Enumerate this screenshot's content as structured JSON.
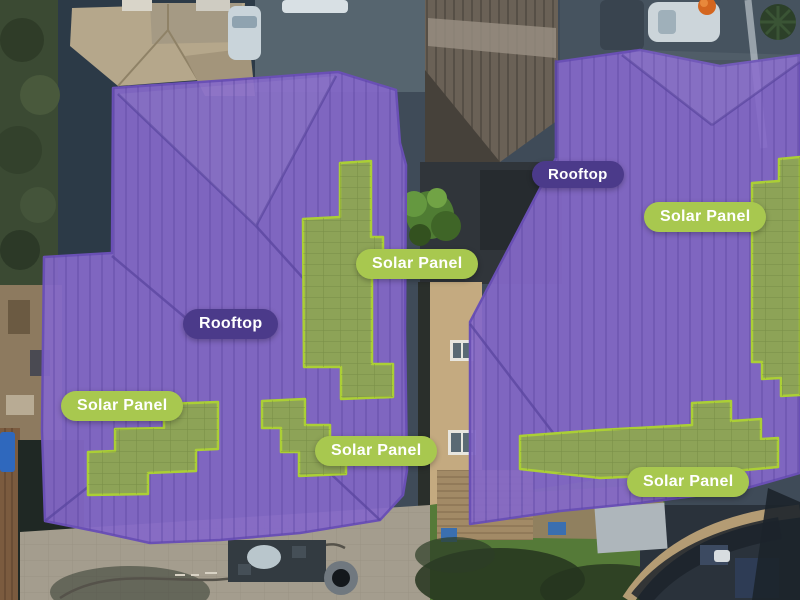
{
  "annotations": [
    {
      "id": "rooftop-left",
      "label": "Rooftop",
      "class": "rooftop"
    },
    {
      "id": "solar-panel-center",
      "label": "Solar Panel",
      "class": "solar_panel"
    },
    {
      "id": "solar-panel-bottom-left",
      "label": "Solar Panel",
      "class": "solar_panel"
    },
    {
      "id": "solar-panel-bottom-mid",
      "label": "Solar Panel",
      "class": "solar_panel"
    },
    {
      "id": "rooftop-right",
      "label": "Rooftop",
      "class": "rooftop"
    },
    {
      "id": "solar-panel-right-top",
      "label": "Solar Panel",
      "class": "solar_panel"
    },
    {
      "id": "solar-panel-right-bottom",
      "label": "Solar Panel",
      "class": "solar_panel"
    }
  ],
  "classes": {
    "rooftop": {
      "name": "Rooftop",
      "badge_color": "#4b3a8a",
      "mask_fill": "#8468c8",
      "mask_border": "#6a50b5"
    },
    "solar_panel": {
      "name": "Solar Panel",
      "badge_color": "#a8c84f",
      "mask_fill": "#8da357",
      "mask_border": "#abcf35"
    }
  },
  "badge_text_color": "#ffffff"
}
